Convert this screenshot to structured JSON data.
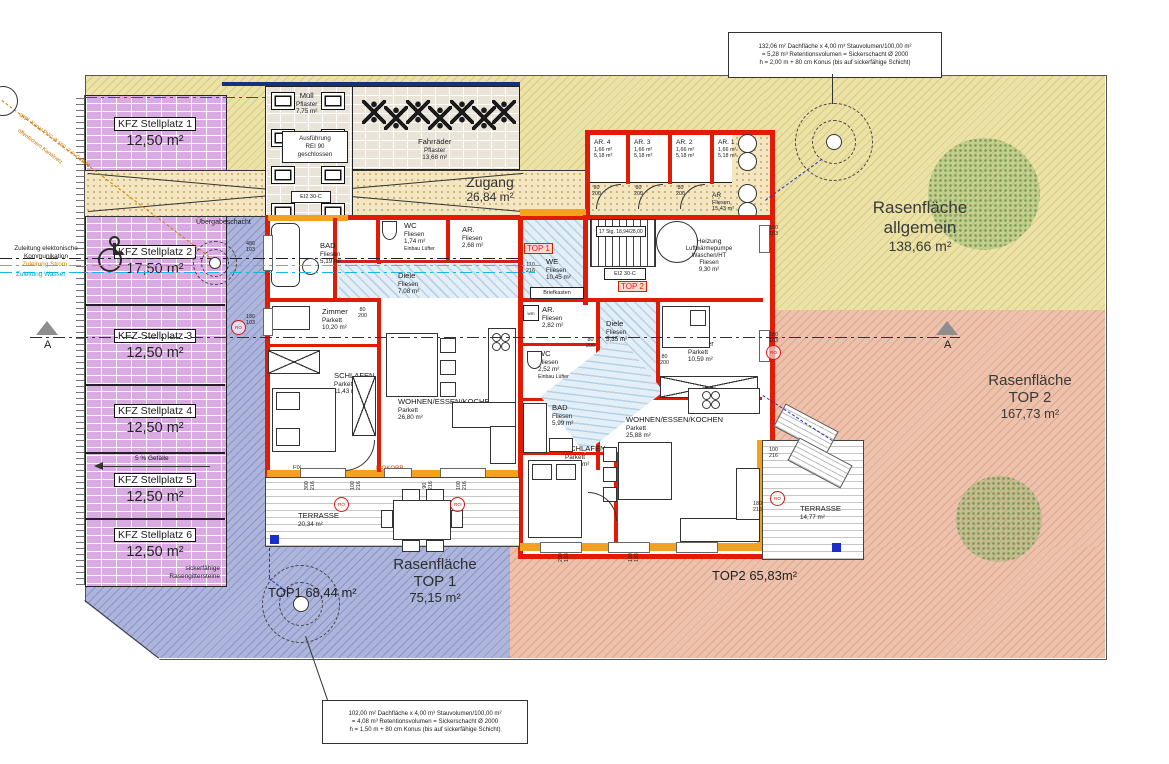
{
  "notes": {
    "note_right": [
      "132,06 m² Dachfläche x 4,00 m³ Stauvolumen/100,00 m²",
      "= 5,28 m³ Retentionsvolumen = Sickerschacht Ø 2000",
      "h = 2,00 m + 80 cm Konus (bis auf sickerfähige Schicht)"
    ],
    "note_bottom": [
      "102,00 m² Dachfläche x 4,00 m³ Stauvolumen/100,00 m²",
      "= 4,08 m³ Retentionsvolumen = Sickerschacht Ø 2000",
      "h = 1,50 m + 80 cm Konus (bis auf sickerfähige Schicht)"
    ]
  },
  "utilities": {
    "kommunikation1": "Zuleitung elektonische",
    "kommunikation2": "Kommunikation",
    "strom": "Zuleitung Strom",
    "wasser": "Zuleitung Wasser",
    "kanal1": "gepl. Kanal PVC Ø 150, 2 % Gefälle",
    "kanal2": "öffentlichem Kanalnetz",
    "uebergabeschacht": "Übergabeschacht",
    "section": "A"
  },
  "parking": {
    "stalls": [
      {
        "name": "KFZ Stellplatz 1",
        "area": "12,50 m²"
      },
      {
        "name": "KFZ Stellplatz 2",
        "area": "17,50 m²"
      },
      {
        "name": "KFZ Stellplatz 3",
        "area": "12,50 m²"
      },
      {
        "name": "KFZ Stellplatz 4",
        "area": "12,50 m²"
      },
      {
        "name": "KFZ Stellplatz 5",
        "area": "12,50 m²"
      },
      {
        "name": "KFZ Stellplatz 6",
        "area": "12,50 m²"
      }
    ],
    "slope": "5 % Gefälle",
    "surface1": "sickerfähige",
    "surface2": "Rasengittersteine"
  },
  "entrance": {
    "muell": [
      "Müll",
      "Pflaster",
      "7,75 m²"
    ],
    "rei": [
      "Ausführung",
      "REI 90",
      "geschlossen"
    ],
    "bikes": [
      "Fahrräder",
      "Pflaster",
      "13,68 m²"
    ],
    "zugang": [
      "Zugang",
      "26,84 m²"
    ],
    "fire_door": "EI2 30-C"
  },
  "ar_block": {
    "rooms": [
      {
        "name": "AR. 4",
        "area": "1,66 m²",
        "vol": "5,18 m³"
      },
      {
        "name": "AR. 3",
        "area": "1,66 m²",
        "vol": "5,18 m³"
      },
      {
        "name": "AR. 2",
        "area": "1,66 m²",
        "vol": "5,18 m³"
      },
      {
        "name": "AR. 1",
        "area": "1,66 m²",
        "vol": "5,18 m³"
      }
    ],
    "hall": [
      "AR",
      "Fliesen",
      "15,43 m²"
    ]
  },
  "common": {
    "stair": "17 Stg. 18,94/28,00",
    "technik": [
      "Heizung",
      "Luftwärmepumpe",
      "Waschen/HT",
      "Fliesen",
      "9,30 m²"
    ]
  },
  "top1": {
    "tag": "TOP 1",
    "entry": [
      "WE",
      "Fliesen",
      "10,45 m²"
    ],
    "briefkasten": "Briefkasten",
    "bad": [
      "BAD",
      "Fliesen",
      "5,19 m²"
    ],
    "wc": [
      "WC",
      "Fliesen",
      "1,74 m²"
    ],
    "wc_note": "Einbau Lüfter",
    "ar": [
      "AR.",
      "Fliesen",
      "2,68 m²"
    ],
    "diele": [
      "Diele",
      "Fliesen",
      "7,08 m²"
    ],
    "zimmer": [
      "Zimmer",
      "Parkett",
      "10,20 m²"
    ],
    "schlafen": [
      "SCHLAFEN",
      "Parkett",
      "11,43 m²"
    ],
    "wohnen": [
      "WOHNEN/ESSEN/KOCHEN",
      "Parkett",
      "26,80 m²"
    ],
    "terrasse": [
      "TERRASSE",
      "20,34 m²"
    ],
    "fix": "FIX",
    "isokorb": "ISOKORB",
    "ground": "TOP1  68,44 m²"
  },
  "top2": {
    "tag": "TOP 2",
    "ar": [
      "AR.",
      "Fliesen",
      "2,82 m²"
    ],
    "wm": "wm",
    "wc": [
      "WC",
      "Fliesen",
      "2,52 m²"
    ],
    "wc_note": "Einbau Lüfter",
    "diele": [
      "Diele",
      "Fliesen",
      "5,35 m²"
    ],
    "zimmer": [
      "Zimmer",
      "Parkett",
      "10,59 m²"
    ],
    "bad": [
      "BAD",
      "Fliesen",
      "5,99 m²"
    ],
    "schlafen": [
      "SCHLAFEN",
      "Parkett",
      "11,98 m²"
    ],
    "wohnen": [
      "WOHNEN/ESSEN/KOCHEN",
      "Parkett",
      "25,88 m²"
    ],
    "terrasse": [
      "TERRASSE",
      "14,77 m²"
    ],
    "ground": "TOP2  65,83m²"
  },
  "lawns": {
    "allgemein": [
      "Rasenfläche",
      "allgemein",
      "138,66 m²"
    ],
    "top2": [
      "Rasenfläche",
      "TOP 2",
      "167,73 m²"
    ],
    "top1": [
      "Rasenfläche",
      "TOP 1",
      "75,15 m²"
    ]
  },
  "dims": {
    "left1": [
      "480",
      "103"
    ],
    "left2": [
      "180",
      "103"
    ],
    "right1": [
      "100",
      "103"
    ],
    "right2": [
      "180",
      "103"
    ],
    "right3": [
      "100",
      "216"
    ],
    "right4": [
      "180",
      "216"
    ],
    "entry": [
      "110",
      "216"
    ],
    "b1": [
      "300",
      "216"
    ],
    "b2": [
      "100",
      "216"
    ],
    "b3": [
      "90",
      "216"
    ],
    "b4": [
      "100",
      "216"
    ],
    "rb1": [
      "200",
      "133"
    ],
    "rb2": [
      "100",
      "133"
    ],
    "door": [
      "80",
      "200"
    ]
  },
  "markers": {
    "ro": "RO"
  }
}
